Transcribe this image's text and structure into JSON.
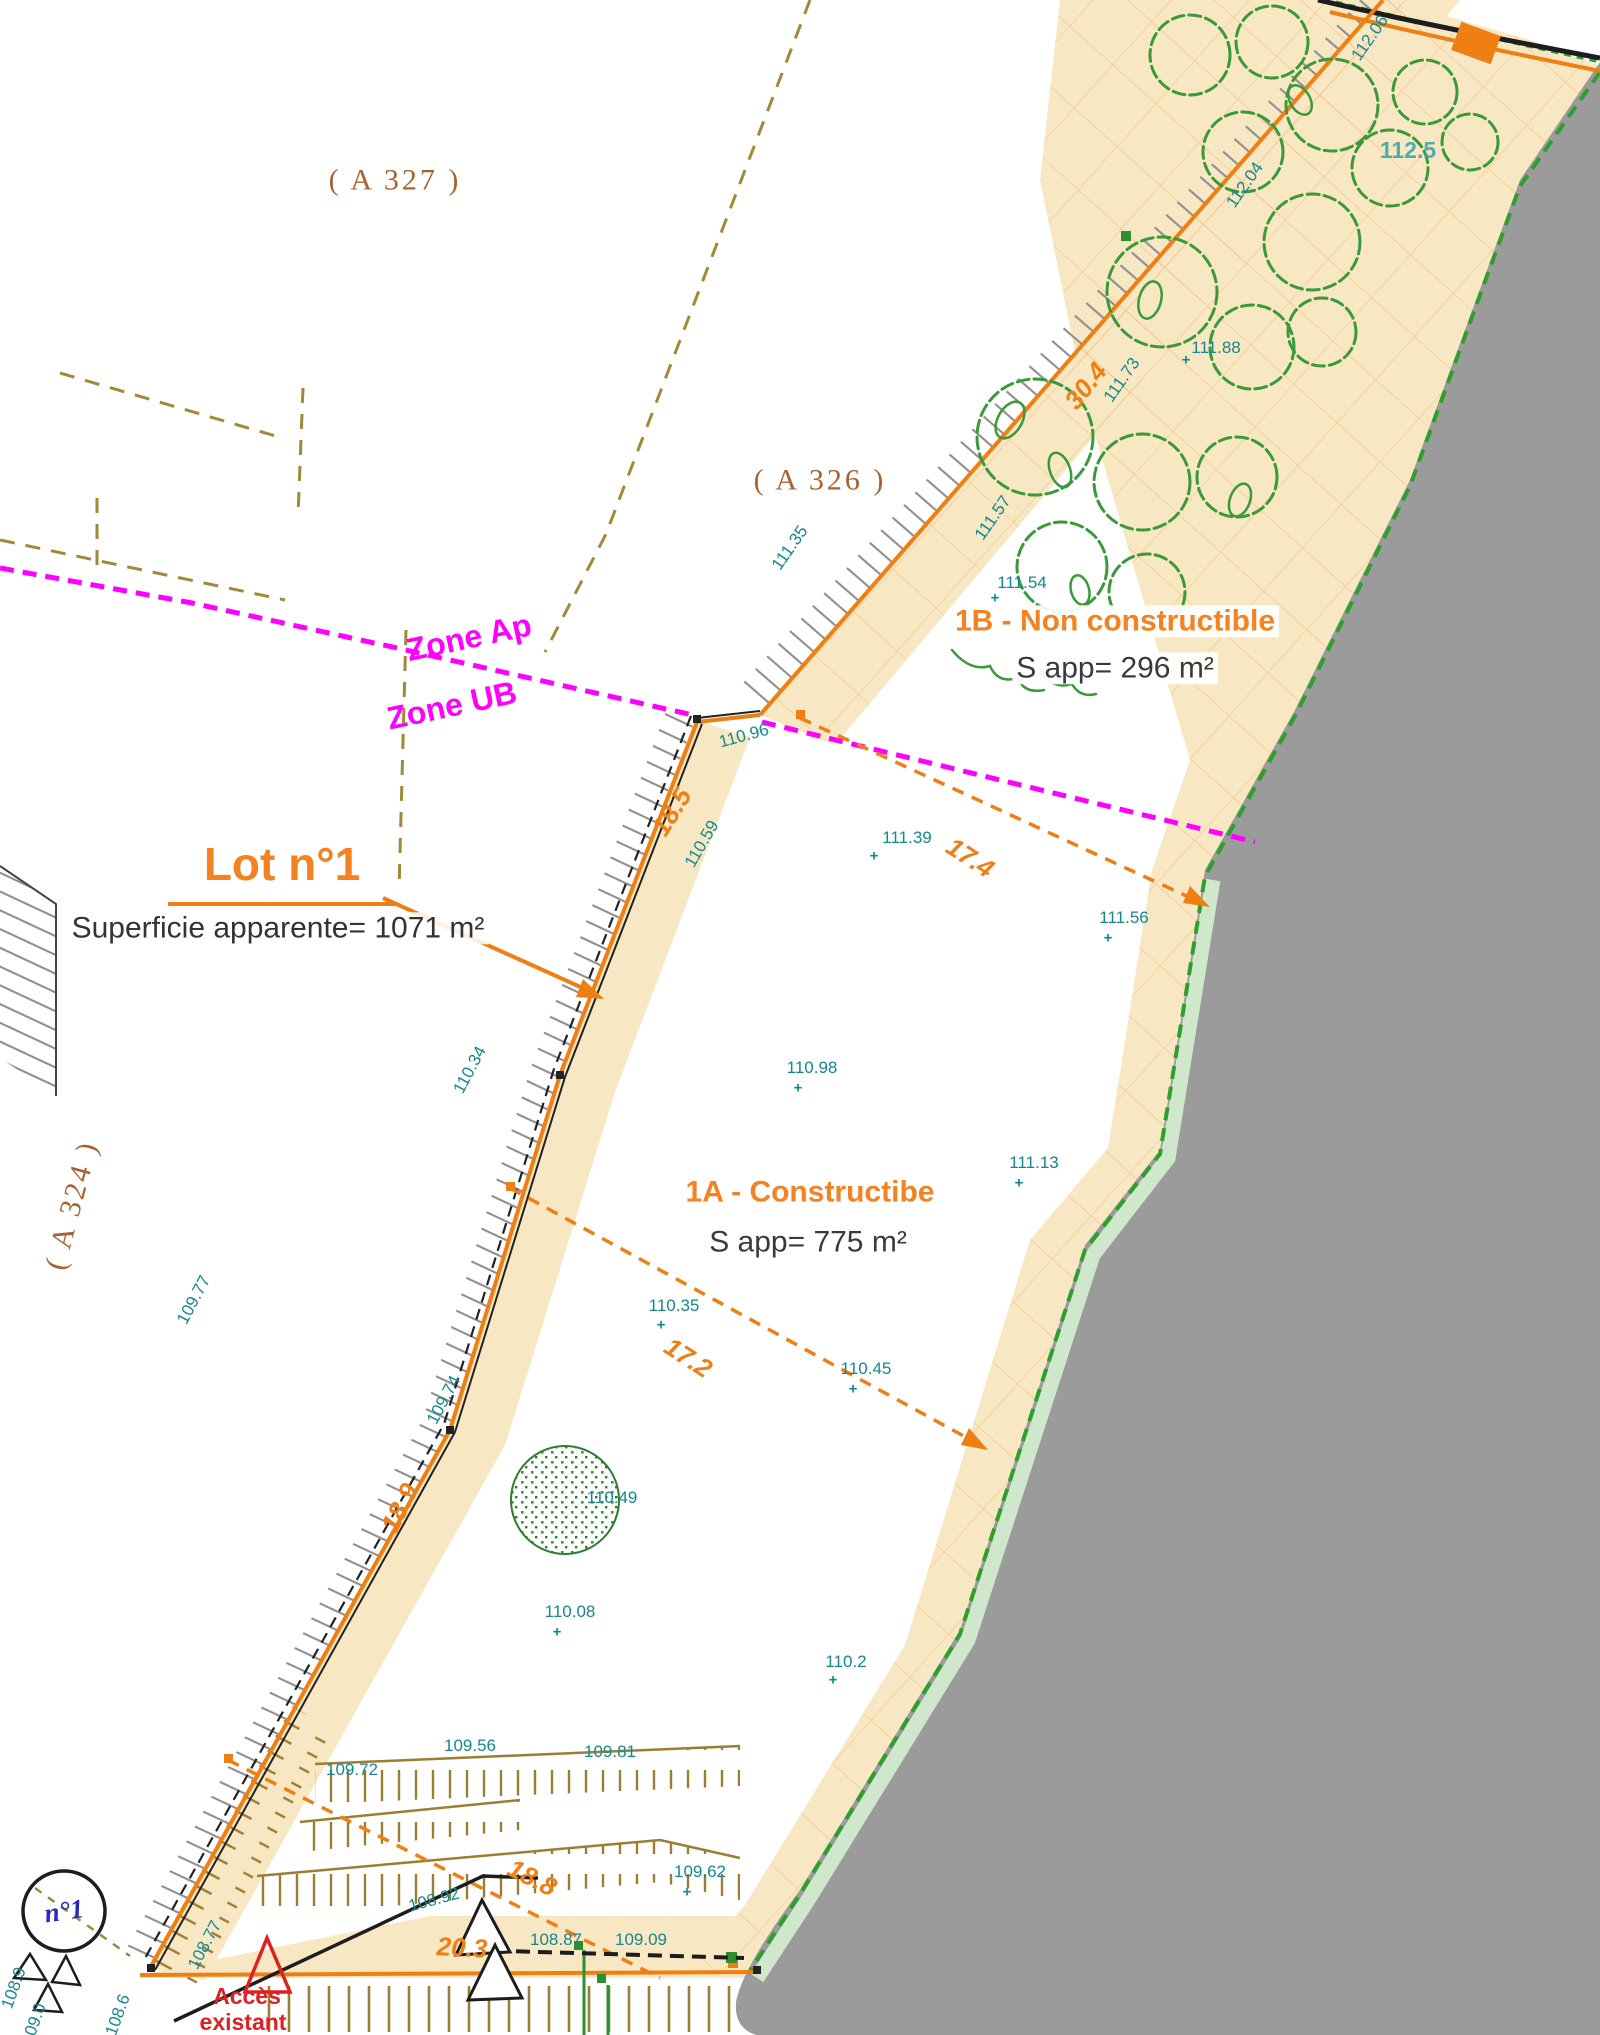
{
  "document": "Plan de division - lotissement",
  "colors": {
    "band_beige": "#f7e7c2",
    "road_gray": "#9b9b9b",
    "boundary_orange": "#f07f13",
    "zone_magenta": "#ff00ff",
    "elevation_teal": "#15888f",
    "vegetation_green": "#3a9a3a",
    "limit_green": "#2f9e2f",
    "cadastre_olive": "#a08a3a",
    "parcel_brown": "#a8622f",
    "access_red": "#e02020",
    "marker_blue": "#2727c4"
  },
  "labels": [
    {
      "name": "parcel-ref-a327",
      "text": "( A 327 )",
      "x": 395,
      "y": 180,
      "cls": "parcel"
    },
    {
      "name": "parcel-ref-a326",
      "text": "( A 326 )",
      "x": 820,
      "y": 480,
      "cls": "parcel"
    },
    {
      "name": "parcel-ref-a324",
      "text": "( A 324 )",
      "x": 72,
      "y": 1205,
      "rot": -75,
      "cls": "parcel"
    },
    {
      "name": "zone-label-ap",
      "text": "Zone Ap",
      "x": 469,
      "y": 638,
      "rot": -12,
      "cls": "zone"
    },
    {
      "name": "zone-label-ub",
      "text": "Zone UB",
      "x": 452,
      "y": 706,
      "rot": -12,
      "cls": "zone"
    },
    {
      "name": "lot1-title",
      "text": "Lot n°1",
      "x": 282,
      "y": 864,
      "cls": "lot-title"
    },
    {
      "name": "lot1-area",
      "text": "Superficie apparente= 1071 m²",
      "x": 278,
      "y": 928,
      "cls": "lot-area"
    },
    {
      "name": "zone1b-title",
      "text": "1B - Non constructible",
      "x": 1115,
      "y": 621,
      "cls": "zone-title"
    },
    {
      "name": "zone1b-area",
      "text": "S app= 296 m²",
      "x": 1115,
      "y": 668,
      "cls": "zone-area"
    },
    {
      "name": "zone1a-title",
      "text": "1A - Constructibe",
      "x": 810,
      "y": 1192,
      "cls": "zone-title"
    },
    {
      "name": "zone1a-area",
      "text": "S app= 775 m²",
      "x": 808,
      "y": 1242,
      "cls": "zone-area"
    },
    {
      "name": "lot-marker-n1",
      "text": "n°1",
      "x": 64,
      "y": 1911,
      "rot": -8,
      "cls": "n1"
    },
    {
      "name": "access-label-line1",
      "text": "Accès",
      "x": 247,
      "y": 1996,
      "cls": "access"
    },
    {
      "name": "access-label-line2",
      "text": "existant",
      "x": 243,
      "y": 2022,
      "cls": "access"
    },
    {
      "name": "dimension",
      "text": "30.4",
      "x": 1086,
      "y": 386,
      "rot": -52,
      "cls": "dim"
    },
    {
      "name": "dimension",
      "text": "17.4",
      "x": 970,
      "y": 858,
      "rot": 33,
      "cls": "dim"
    },
    {
      "name": "dimension",
      "text": "17.2",
      "x": 688,
      "y": 1358,
      "rot": 33,
      "cls": "dim"
    },
    {
      "name": "dimension",
      "text": "18.5",
      "x": 672,
      "y": 812,
      "rot": -58,
      "cls": "dim"
    },
    {
      "name": "dimension",
      "text": "18.9",
      "x": 400,
      "y": 1508,
      "rot": -63,
      "cls": "dim"
    },
    {
      "name": "dimension",
      "text": "18.8",
      "x": 532,
      "y": 1878,
      "rot": 27,
      "cls": "dim"
    },
    {
      "name": "dimension",
      "text": "20.3",
      "x": 462,
      "y": 1948,
      "rot": 3,
      "cls": "dim"
    },
    {
      "name": "elevation-point",
      "text": "112.06",
      "x": 1370,
      "y": 38,
      "rot": -55,
      "cls": "elev"
    },
    {
      "name": "elevation-point",
      "text": "112.5",
      "x": 1408,
      "y": 150,
      "cls": "elev-lg"
    },
    {
      "name": "elevation-point",
      "text": "112.04",
      "x": 1245,
      "y": 185,
      "rot": -55,
      "cls": "elev"
    },
    {
      "name": "elevation-point",
      "text": "111.88",
      "x": 1216,
      "y": 348,
      "mx": 1186,
      "my": 360,
      "cls": "elev"
    },
    {
      "name": "elevation-point",
      "text": "111.73",
      "x": 1122,
      "y": 380,
      "rot": -55,
      "cls": "elev"
    },
    {
      "name": "elevation-point",
      "text": "111.57",
      "x": 993,
      "y": 518,
      "rot": -55,
      "cls": "elev"
    },
    {
      "name": "elevation-point",
      "text": "111.54",
      "x": 1022,
      "y": 583,
      "mx": 995,
      "my": 598,
      "cls": "elev"
    },
    {
      "name": "elevation-point",
      "text": "111.35",
      "x": 790,
      "y": 548,
      "rot": -55,
      "cls": "elev"
    },
    {
      "name": "elevation-point",
      "text": "111.39",
      "x": 907,
      "y": 838,
      "mx": 874,
      "my": 856,
      "cls": "elev"
    },
    {
      "name": "elevation-point",
      "text": "111.56",
      "x": 1124,
      "y": 918,
      "mx": 1108,
      "my": 938,
      "cls": "elev"
    },
    {
      "name": "elevation-point",
      "text": "110.98",
      "x": 812,
      "y": 1068,
      "mx": 798,
      "my": 1088,
      "cls": "elev"
    },
    {
      "name": "elevation-point",
      "text": "111.13",
      "x": 1034,
      "y": 1163,
      "mx": 1019,
      "my": 1183,
      "cls": "elev"
    },
    {
      "name": "elevation-point",
      "text": "110.35",
      "x": 674,
      "y": 1306,
      "mx": 661,
      "my": 1325,
      "cls": "elev"
    },
    {
      "name": "elevation-point",
      "text": "110.45",
      "x": 866,
      "y": 1369,
      "mx": 853,
      "my": 1389,
      "cls": "elev"
    },
    {
      "name": "elevation-point",
      "text": "110.49",
      "x": 612,
      "y": 1498,
      "cls": "elev"
    },
    {
      "name": "elevation-point",
      "text": "110.08",
      "x": 570,
      "y": 1612,
      "mx": 557,
      "my": 1632,
      "cls": "elev"
    },
    {
      "name": "elevation-point",
      "text": "110.2",
      "x": 846,
      "y": 1662,
      "mx": 833,
      "my": 1680,
      "cls": "elev"
    },
    {
      "name": "elevation-point",
      "text": "109.62",
      "x": 700,
      "y": 1872,
      "mx": 687,
      "my": 1892,
      "cls": "elev"
    },
    {
      "name": "elevation-point",
      "text": "109.72",
      "x": 352,
      "y": 1770,
      "cls": "elev"
    },
    {
      "name": "elevation-point",
      "text": "109.56",
      "x": 470,
      "y": 1746,
      "cls": "elev"
    },
    {
      "name": "elevation-point",
      "text": "109.81",
      "x": 610,
      "y": 1752,
      "cls": "elev"
    },
    {
      "name": "elevation-point",
      "text": "108.87",
      "x": 556,
      "y": 1940,
      "cls": "elev"
    },
    {
      "name": "elevation-point",
      "text": "109.09",
      "x": 641,
      "y": 1940,
      "cls": "elev"
    },
    {
      "name": "elevation-point",
      "text": "108.92",
      "x": 434,
      "y": 1900,
      "rot": -15,
      "cls": "elev"
    },
    {
      "name": "elevation-point",
      "text": "110.96",
      "x": 744,
      "y": 736,
      "rot": -15,
      "cls": "elev"
    },
    {
      "name": "elevation-point",
      "text": "110.59",
      "x": 702,
      "y": 844,
      "rot": -60,
      "cls": "elev"
    },
    {
      "name": "elevation-point",
      "text": "110.34",
      "x": 470,
      "y": 1070,
      "rot": -62,
      "cls": "elev"
    },
    {
      "name": "elevation-point",
      "text": "109.74",
      "x": 444,
      "y": 1400,
      "rot": -62,
      "cls": "elev"
    },
    {
      "name": "elevation-point",
      "text": "109.77",
      "x": 194,
      "y": 1300,
      "rot": -62,
      "cls": "elev"
    },
    {
      "name": "elevation-point",
      "text": "108.77",
      "x": 205,
      "y": 1945,
      "rot": -62,
      "cls": "elev"
    },
    {
      "name": "elevation-point",
      "text": "108.9",
      "x": 14,
      "y": 1988,
      "rot": -70,
      "cls": "elev"
    },
    {
      "name": "elevation-point",
      "text": "109.0",
      "x": 34,
      "y": 2024,
      "rot": -70,
      "cls": "elev"
    },
    {
      "name": "elevation-point",
      "text": "108.6",
      "x": 118,
      "y": 2015,
      "rot": -70,
      "cls": "elev"
    }
  ]
}
